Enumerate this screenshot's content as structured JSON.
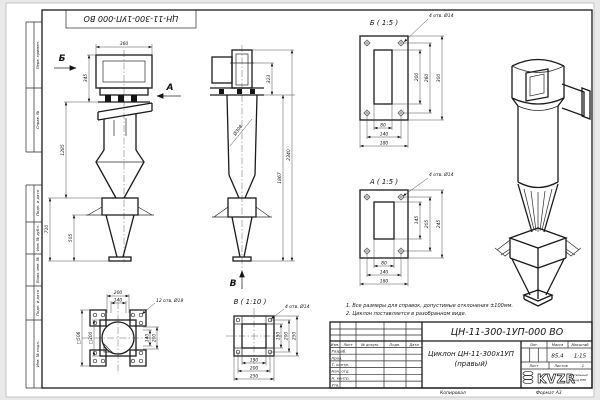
{
  "doc": {
    "stamp": "ЦН-11-300-1УП-000 ВО",
    "margins": [
      "Перв. примен.",
      "Справ. №",
      "Подп. и дата",
      "Инв. № дубл.",
      "Взам. инв. №",
      "Подп. и дата",
      "Инв. № подл."
    ],
    "copied": "Копировал",
    "format": "Формат А3"
  },
  "side": {
    "b": "Б",
    "a": "А",
    "d360": "360",
    "d345": "345",
    "d1285": "1285",
    "d710": "710",
    "d505": "505"
  },
  "front": {
    "v": "В",
    "dia": "Ø308",
    "d323": "323",
    "d1867": "1867",
    "d2340": "2340"
  },
  "flange": {
    "holes": "12 отв. Ø18",
    "t200": "200",
    "t140": "140",
    "s506": "□506",
    "s300": "□300",
    "r140": "140",
    "r200": "200"
  },
  "db": {
    "title": "Б ( 1:5 )",
    "holes": "4 отв. Ø14",
    "v1": "200",
    "v2": "260",
    "v3": "300",
    "h1": "80",
    "h2": "140",
    "h3": "180"
  },
  "da": {
    "title": "А ( 1:5 )",
    "holes": "4 отв. Ø14",
    "v1": "145",
    "v2": "205",
    "v3": "245",
    "h1": "80",
    "h2": "140",
    "h3": "180"
  },
  "dv": {
    "title": "В ( 1:10 )",
    "holes": "4 отв. Ø14",
    "v1": "150",
    "v2": "200",
    "v3": "250",
    "h1": "150",
    "h2": "200",
    "h3": "250"
  },
  "notes": [
    "1. Все размеры для справок, допустимые отклонения ±100мм.",
    "2. Циклон поставляется в разобранном виде."
  ],
  "tb": {
    "designation": "ЦН-11-300-1УП-000 ВО",
    "name1": "Циклон ЦН-11-300х1УП",
    "name2": "(правый)",
    "cols": [
      "Изм.",
      "Лист",
      "№ докум.",
      "Подп.",
      "Дата"
    ],
    "roles": [
      "Разраб.",
      "Пров.",
      "Т. контр.",
      "Нач. отд.",
      "Н. контр.",
      "Утв."
    ],
    "lit": "Лит.",
    "mass_l": "Масса",
    "scale_l": "Масштаб",
    "mass": "85,4",
    "scale": "1:15",
    "sheet_l": "Лист",
    "sheets_l": "Листов",
    "sheets": "1",
    "logo": "KVZR",
    "co1": "Котельный",
    "co2": "завод РЭП"
  }
}
